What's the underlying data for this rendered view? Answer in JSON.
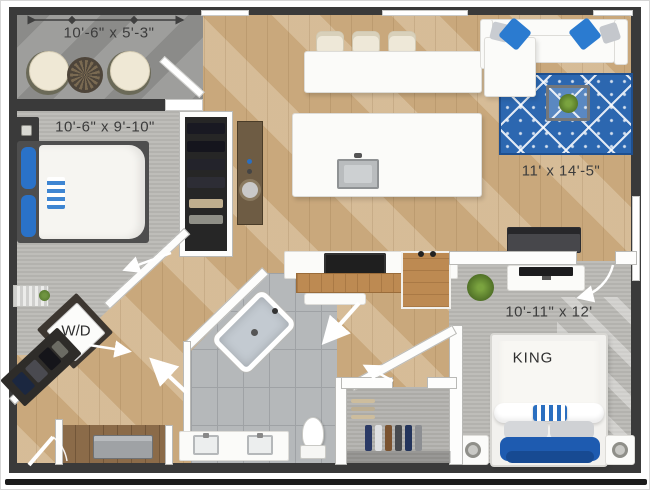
{
  "title": "Apartment floor plan",
  "rooms": {
    "balcony": {
      "dimension": "10'-6\" x 5'-3\""
    },
    "bedroom_2": {
      "dimension": "10'-6\" x 9'-10\""
    },
    "living_room": {
      "dimension": "11' x 14'-5\""
    },
    "bedroom_1": {
      "dimension": "10'-11\" x 12'",
      "bed_label": "KING"
    },
    "laundry": {
      "label": "W/D"
    }
  },
  "colors": {
    "exterior_wall": "#3a3a3a",
    "interior_wall": "#fdfdfc",
    "wood_floor": "#c9a87c",
    "carpet": "#bab9b5",
    "balcony_concrete": "#9e9e9c",
    "bathroom_tile": "#b5b8ba",
    "rug_blue": "#2c67b0",
    "pillow_blue": "#2b7bd0",
    "bed_blanket_blue": "#1e5bb0",
    "dimension_text": "#3c3c3c"
  }
}
